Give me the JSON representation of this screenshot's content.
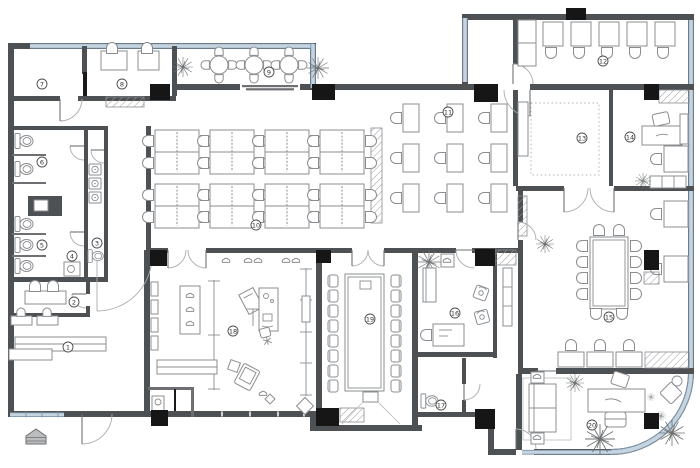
{
  "document": {
    "type": "office-floor-plan",
    "canvas_width": 700,
    "canvas_height": 468
  },
  "palette": {
    "wall": "#4e5154",
    "partition": "#6d6f72",
    "window_fill": "#c6d4e0",
    "window_edge": "#7d97ad",
    "column": "#161616",
    "furniture_line": "#8b8d90",
    "badge_ring": "#4c4c4c",
    "badge_text": "#333333",
    "background": "#ffffff"
  },
  "rooms": [
    {
      "number": "1",
      "name": "storage-room",
      "x": 68,
      "y": 347
    },
    {
      "number": "2",
      "name": "interview-room",
      "x": 74,
      "y": 302
    },
    {
      "number": "3",
      "name": "washroom",
      "x": 97,
      "y": 243
    },
    {
      "number": "4",
      "name": "restroom-lobby",
      "x": 72,
      "y": 256
    },
    {
      "number": "5",
      "name": "toilet-south",
      "x": 42,
      "y": 245
    },
    {
      "number": "6",
      "name": "toilet-north",
      "x": 42,
      "y": 162
    },
    {
      "number": "7",
      "name": "storeroom",
      "x": 42,
      "y": 84
    },
    {
      "number": "8",
      "name": "admin-office",
      "x": 122,
      "y": 84
    },
    {
      "number": "9",
      "name": "outdoor-terrace",
      "x": 269,
      "y": 72
    },
    {
      "number": "10",
      "name": "open-office-west",
      "x": 256,
      "y": 225
    },
    {
      "number": "11",
      "name": "open-office-east",
      "x": 448,
      "y": 112
    },
    {
      "number": "12",
      "name": "training-room",
      "x": 603,
      "y": 61
    },
    {
      "number": "13",
      "name": "multipurpose-room",
      "x": 582,
      "y": 138
    },
    {
      "number": "14",
      "name": "manager-office",
      "x": 630,
      "y": 137
    },
    {
      "number": "15",
      "name": "sales-office",
      "x": 609,
      "y": 317
    },
    {
      "number": "16",
      "name": "reception-lounge",
      "x": 455,
      "y": 313
    },
    {
      "number": "17",
      "name": "guest-toilet",
      "x": 441,
      "y": 405
    },
    {
      "number": "18",
      "name": "showroom",
      "x": 233,
      "y": 331
    },
    {
      "number": "19",
      "name": "presentation-room",
      "x": 370,
      "y": 319
    },
    {
      "number": "20",
      "name": "executive-office",
      "x": 592,
      "y": 425
    }
  ],
  "entrance": {
    "name": "main-entrance-canopy",
    "x": 36,
    "y": 437
  }
}
